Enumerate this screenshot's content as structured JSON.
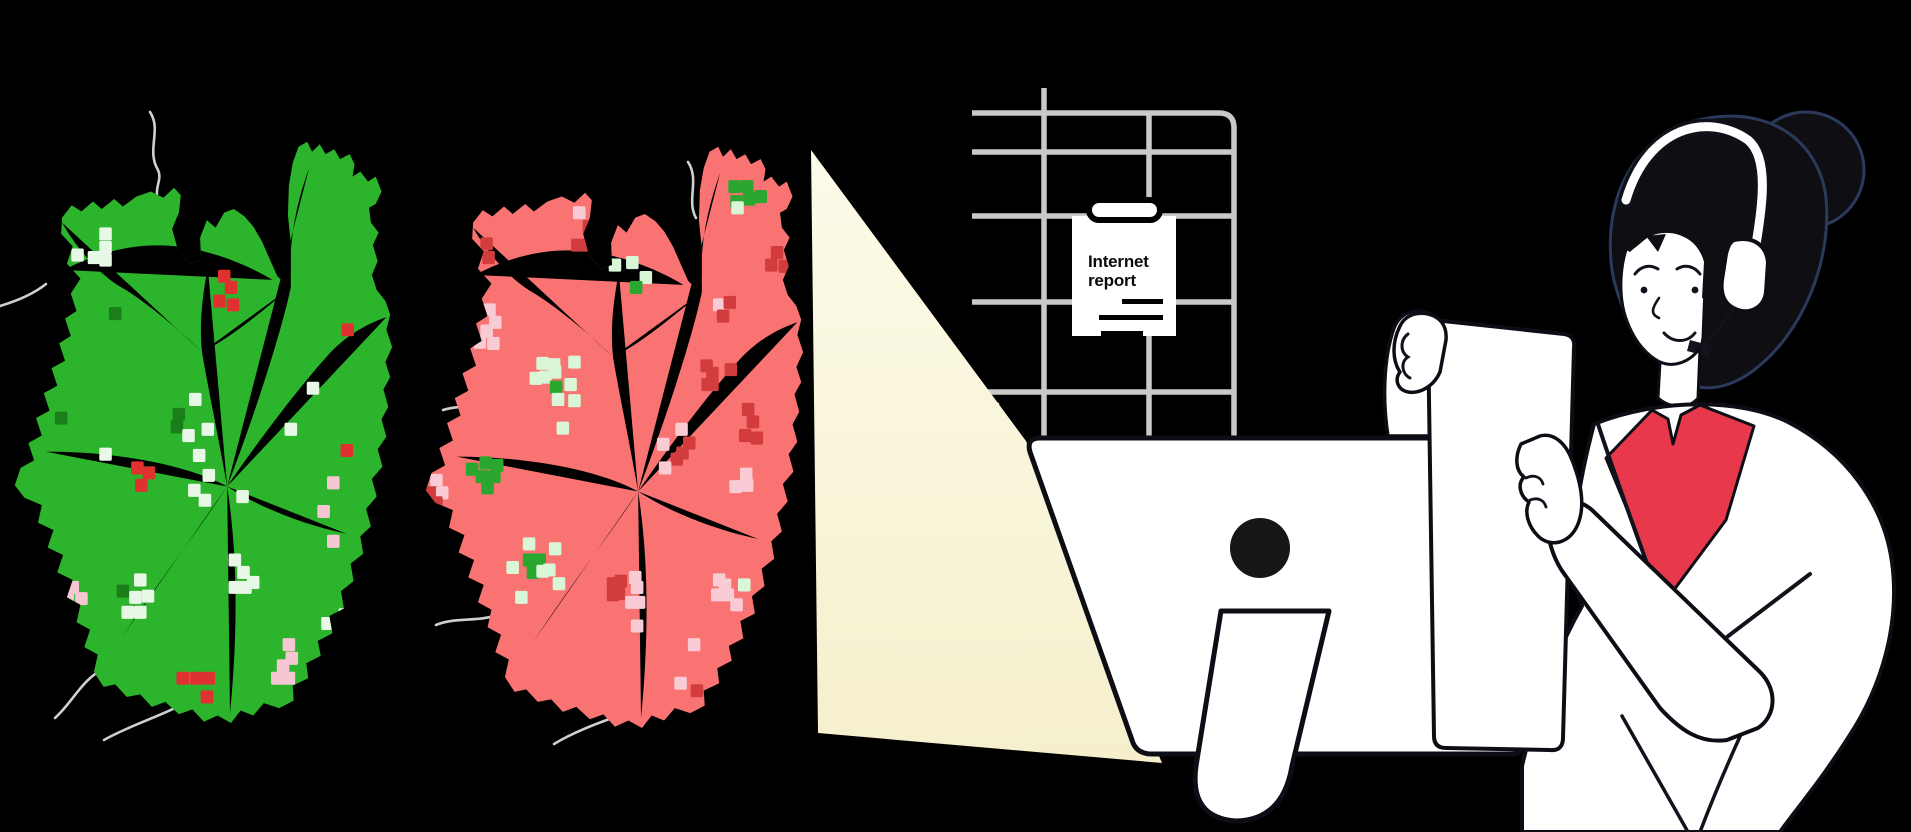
{
  "report_card": {
    "title": "Internet report"
  },
  "palette": {
    "background": "#000000",
    "crack": "#cfcfcf",
    "grid": "#c9c9c9",
    "beam_top": "#fdfbe9",
    "beam_bottom": "#f5efcc",
    "monitor_body": "#ffffff",
    "outline": "#0d0d16",
    "camera": "#161616",
    "hair": "#0e0e13",
    "hair_edge": "#2b3a5c",
    "skin": "#ffffff",
    "shirt": "#e8394c",
    "coat": "#ffffff",
    "paper": "#ffffff"
  },
  "maps": {
    "healthy": {
      "label": "healthy-region-map",
      "fill": "#2cb42c",
      "dot_colors": {
        "m": "#e8f8e6",
        "g": "#1a7f1a",
        "r": "#e03131",
        "p": "#f6c7d2"
      },
      "dots": [
        [
          99,
          77,
          "m"
        ],
        [
          99,
          88,
          "m"
        ],
        [
          70,
          94,
          "m"
        ],
        [
          87,
          96,
          "m"
        ],
        [
          99,
          98,
          "m"
        ],
        [
          222,
          111,
          "r"
        ],
        [
          229,
          120,
          "r"
        ],
        [
          217,
          131,
          "r"
        ],
        [
          231,
          134,
          "r"
        ],
        [
          109,
          141,
          "g"
        ],
        [
          350,
          154,
          "r"
        ],
        [
          314,
          201,
          "m"
        ],
        [
          53,
          225,
          "g"
        ],
        [
          175,
          222,
          "g"
        ],
        [
          173,
          232,
          "g"
        ],
        [
          192,
          210,
          "m"
        ],
        [
          205,
          234,
          "m"
        ],
        [
          185,
          239,
          "m"
        ],
        [
          99,
          254,
          "m"
        ],
        [
          132,
          265,
          "r"
        ],
        [
          144,
          269,
          "r"
        ],
        [
          136,
          279,
          "r"
        ],
        [
          196,
          255,
          "m"
        ],
        [
          206,
          271,
          "m"
        ],
        [
          191,
          283,
          "m"
        ],
        [
          202,
          291,
          "m"
        ],
        [
          241,
          288,
          "m"
        ],
        [
          291,
          234,
          "m"
        ],
        [
          349,
          251,
          "r"
        ],
        [
          335,
          277,
          "p"
        ],
        [
          325,
          300,
          "p"
        ],
        [
          335,
          324,
          "p"
        ],
        [
          65,
          361,
          "p"
        ],
        [
          60,
          370,
          "p"
        ],
        [
          74,
          370,
          "p"
        ],
        [
          117,
          364,
          "g"
        ],
        [
          135,
          355,
          "m"
        ],
        [
          130,
          369,
          "m"
        ],
        [
          143,
          368,
          "m"
        ],
        [
          122,
          381,
          "m"
        ],
        [
          135,
          381,
          "m"
        ],
        [
          233,
          339,
          "m"
        ],
        [
          242,
          349,
          "m"
        ],
        [
          252,
          357,
          "m"
        ],
        [
          233,
          361,
          "m"
        ],
        [
          244,
          361,
          "m"
        ],
        [
          329,
          390,
          "m"
        ],
        [
          347,
          383,
          "m"
        ],
        [
          348,
          406,
          "m"
        ],
        [
          289,
          407,
          "p"
        ],
        [
          292,
          418,
          "p"
        ],
        [
          283,
          424,
          "p"
        ],
        [
          277,
          434,
          "p"
        ],
        [
          289,
          434,
          "p"
        ],
        [
          179,
          434,
          "r"
        ],
        [
          193,
          434,
          "r"
        ],
        [
          206,
          434,
          "r"
        ],
        [
          204,
          449,
          "r"
        ]
      ]
    },
    "outage": {
      "label": "outage-region-map",
      "fill": "#f97373",
      "dot_colors": {
        "m": "#d9f6d7",
        "g": "#2aa72e",
        "d": "#d23c3c",
        "p": "#f9cbd5"
      },
      "dots": [
        [
          164,
          56,
          "p"
        ],
        [
          174,
          67,
          "d"
        ],
        [
          188,
          67,
          "d"
        ],
        [
          185,
          75,
          "d"
        ],
        [
          162,
          82,
          "d"
        ],
        [
          173,
          82,
          "d"
        ],
        [
          68,
          81,
          "d"
        ],
        [
          70,
          92,
          "d"
        ],
        [
          325,
          35,
          "g"
        ],
        [
          338,
          35,
          "g"
        ],
        [
          327,
          47,
          "g"
        ],
        [
          340,
          45,
          "g"
        ],
        [
          352,
          43,
          "g"
        ],
        [
          328,
          52,
          "m"
        ],
        [
          369,
          88,
          "d"
        ],
        [
          363,
          98,
          "d"
        ],
        [
          377,
          99,
          "d"
        ],
        [
          201,
          98,
          "m"
        ],
        [
          219,
          96,
          "m"
        ],
        [
          233,
          108,
          "m"
        ],
        [
          223,
          116,
          "g"
        ],
        [
          309,
          130,
          "p"
        ],
        [
          320,
          128,
          "d"
        ],
        [
          313,
          139,
          "d"
        ],
        [
          71,
          134,
          "p"
        ],
        [
          77,
          144,
          "p"
        ],
        [
          68,
          151,
          "p"
        ],
        [
          61,
          160,
          "p"
        ],
        [
          75,
          161,
          "p"
        ],
        [
          126,
          177,
          "m"
        ],
        [
          138,
          178,
          "m"
        ],
        [
          159,
          176,
          "m"
        ],
        [
          119,
          189,
          "m"
        ],
        [
          129,
          188,
          "m"
        ],
        [
          139,
          184,
          "m"
        ],
        [
          140,
          196,
          "g"
        ],
        [
          155,
          194,
          "m"
        ],
        [
          142,
          206,
          "m"
        ],
        [
          159,
          207,
          "m"
        ],
        [
          147,
          229,
          "m"
        ],
        [
          296,
          179,
          "d"
        ],
        [
          302,
          185,
          "d"
        ],
        [
          297,
          194,
          "d"
        ],
        [
          321,
          182,
          "d"
        ],
        [
          302,
          194,
          "d"
        ],
        [
          339,
          214,
          "d"
        ],
        [
          344,
          224,
          "d"
        ],
        [
          336,
          235,
          "d"
        ],
        [
          348,
          237,
          "d"
        ],
        [
          270,
          230,
          "p"
        ],
        [
          251,
          242,
          "p"
        ],
        [
          278,
          241,
          "d"
        ],
        [
          271,
          249,
          "d"
        ],
        [
          265,
          254,
          "d"
        ],
        [
          253,
          261,
          "p"
        ],
        [
          337,
          266,
          "p"
        ],
        [
          338,
          275,
          "p"
        ],
        [
          326,
          276,
          "p"
        ],
        [
          53,
          262,
          "g"
        ],
        [
          67,
          257,
          "g"
        ],
        [
          79,
          259,
          "g"
        ],
        [
          63,
          268,
          "g"
        ],
        [
          76,
          268,
          "g"
        ],
        [
          69,
          277,
          "g"
        ],
        [
          16,
          271,
          "p"
        ],
        [
          12,
          281,
          "d"
        ],
        [
          22,
          281,
          "p"
        ],
        [
          8,
          289,
          "d"
        ],
        [
          16,
          289,
          "d"
        ],
        [
          112,
          322,
          "m"
        ],
        [
          139,
          326,
          "m"
        ],
        [
          112,
          335,
          "g"
        ],
        [
          118,
          336,
          "g"
        ],
        [
          123,
          335,
          "g"
        ],
        [
          95,
          341,
          "m"
        ],
        [
          116,
          345,
          "g"
        ],
        [
          126,
          344,
          "m"
        ],
        [
          133,
          343,
          "m"
        ],
        [
          143,
          354,
          "m"
        ],
        [
          104,
          365,
          "m"
        ],
        [
          199,
          354,
          "d"
        ],
        [
          207,
          352,
          "d"
        ],
        [
          199,
          363,
          "d"
        ],
        [
          205,
          362,
          "d"
        ],
        [
          222,
          349,
          "p"
        ],
        [
          224,
          357,
          "p"
        ],
        [
          218,
          369,
          "p"
        ],
        [
          226,
          369,
          "p"
        ],
        [
          224,
          388,
          "p"
        ],
        [
          309,
          351,
          "p"
        ],
        [
          315,
          355,
          "p"
        ],
        [
          307,
          363,
          "p"
        ],
        [
          318,
          363,
          "p"
        ],
        [
          327,
          371,
          "p"
        ],
        [
          335,
          355,
          "m"
        ],
        [
          283,
          403,
          "p"
        ],
        [
          269,
          434,
          "p"
        ],
        [
          286,
          440,
          "d"
        ],
        [
          345,
          455,
          "d"
        ],
        [
          357,
          460,
          "d"
        ]
      ]
    }
  }
}
